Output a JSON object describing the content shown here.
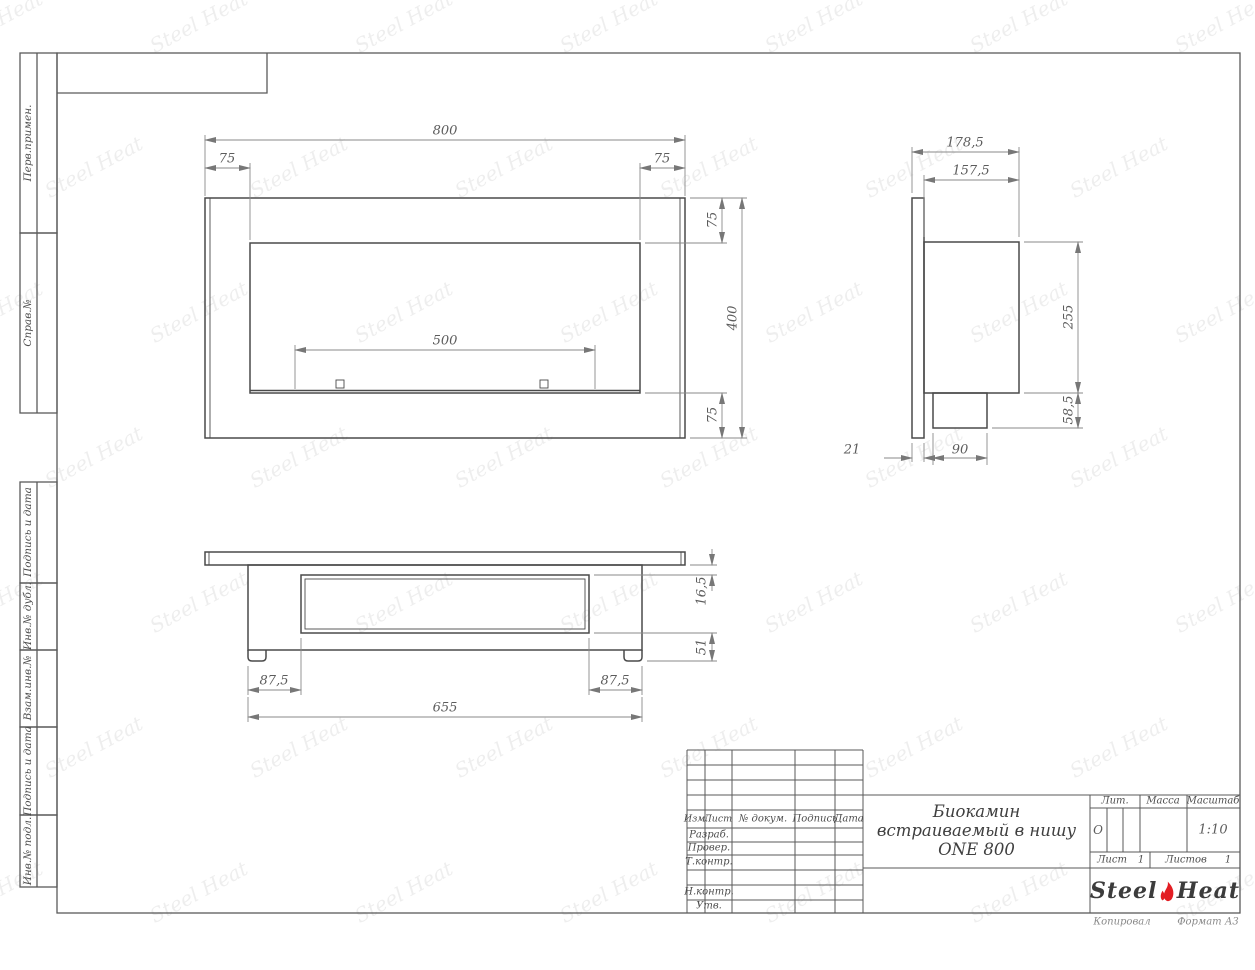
{
  "frame": {
    "left_labels": [
      "Перв.примен.",
      "Справ.№",
      "Подпись и дата",
      "Инв.№ дубл.",
      "Взам.инв.№",
      "Подпись и дата",
      "Инв.№ подл."
    ],
    "footer_left": "Копировал",
    "footer_right": "Формат А3"
  },
  "views": {
    "front": {
      "dim_width": "800",
      "dim_margin_left": "75",
      "dim_margin_right": "75",
      "dim_margin_top": "75",
      "dim_height": "400",
      "dim_margin_bottom": "75",
      "dim_burner_width": "500"
    },
    "side": {
      "dim_depth_total": "178,5",
      "dim_depth_body": "157,5",
      "dim_body_height": "255",
      "dim_burner_height": "58,5",
      "dim_flange_thickness": "21",
      "dim_burner_depth": "90"
    },
    "bottom": {
      "dim_flange_offset": "16,5",
      "dim_inner_depth": "51",
      "dim_margin_left": "87,5",
      "dim_margin_right": "87,5",
      "dim_body_width": "655"
    }
  },
  "title_block": {
    "cols": {
      "izm": "Изм.",
      "list": "Лист",
      "dokum": "№ докум.",
      "podpis": "Подпись",
      "data": "Дата"
    },
    "rows": {
      "razrab": "Разраб.",
      "prover": "Провер.",
      "tkontr": "Т.контр.",
      "nkontr": "Н.контр.",
      "utv": "Утв."
    },
    "title": [
      "Биокамин",
      "встраиваемый в нишу",
      "ONE 800"
    ],
    "lit_label": "Лит.",
    "lit_value": "О",
    "massa_label": "Масса",
    "masshtab_label": "Масштаб",
    "masshtab_value": "1:10",
    "list_label": "Лист",
    "list_value": "1",
    "listov_label": "Листов",
    "listov_value": "1",
    "logo": {
      "steel": "Steel",
      "heat": "Heat"
    }
  },
  "watermark": {
    "text": "Steel Heat"
  },
  "colors": {
    "flame_red": "#e31e24",
    "contour": "#4a4a4a",
    "dim_line": "#8a8a8a"
  }
}
